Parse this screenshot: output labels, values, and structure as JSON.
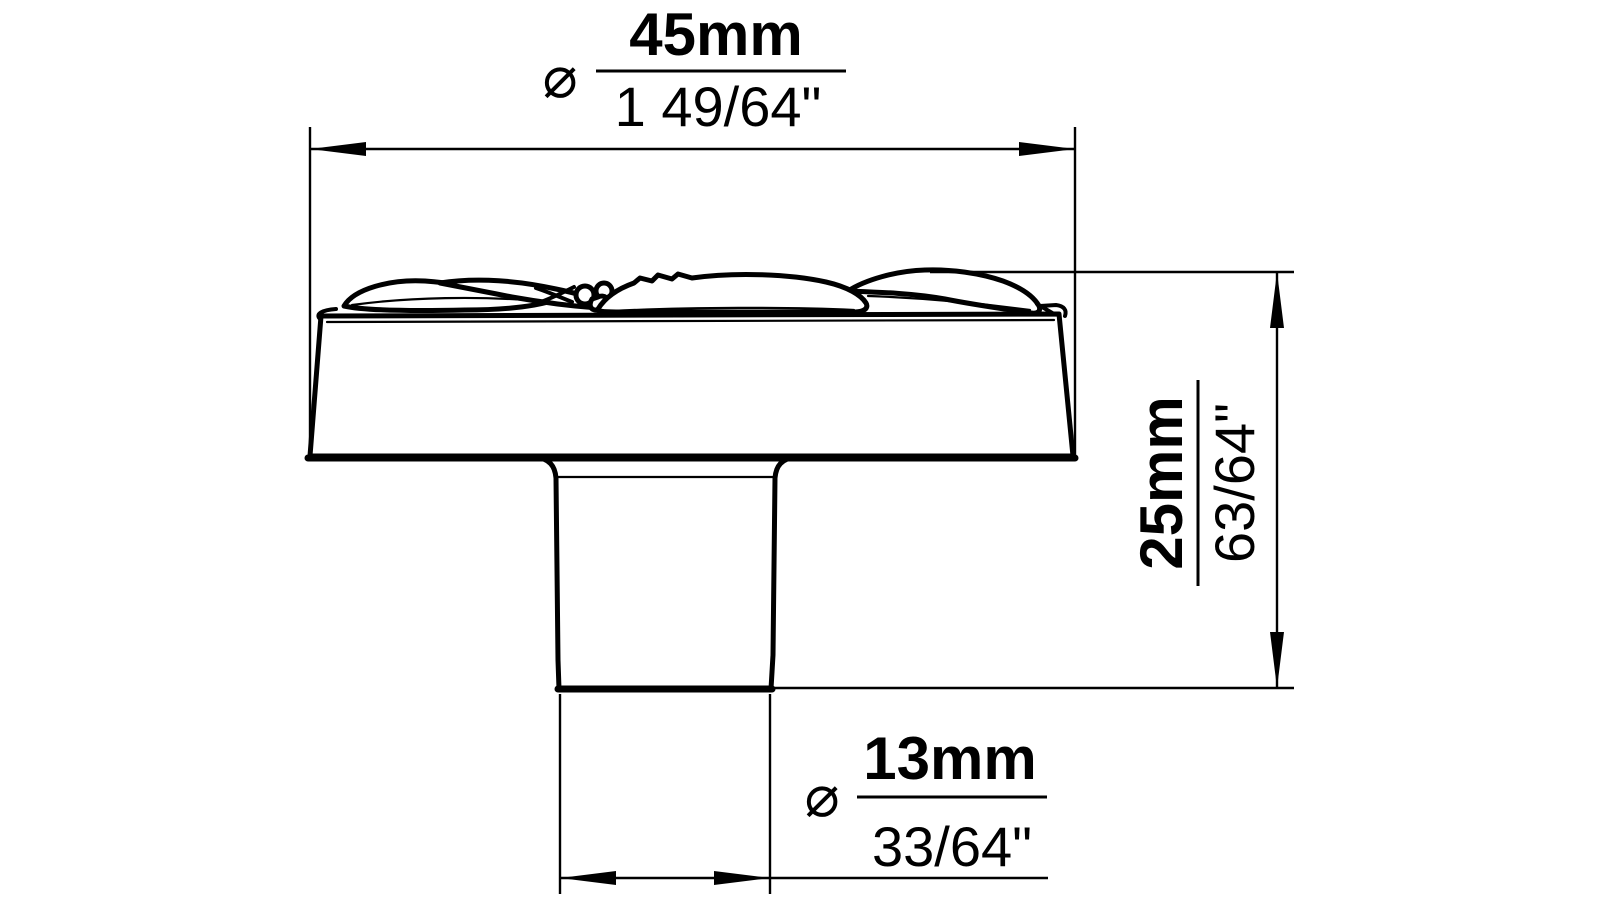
{
  "page": {
    "background_color": "#ffffff",
    "line_color": "#000000"
  },
  "dimensions": {
    "head_diameter": {
      "symbol": "⌀",
      "metric": "45mm",
      "imperial": "1 49/64\""
    },
    "height": {
      "metric": "25mm",
      "imperial": "63/64\""
    },
    "stem_diameter": {
      "symbol": "⌀",
      "metric": "13mm",
      "imperial": "33/64\""
    }
  }
}
